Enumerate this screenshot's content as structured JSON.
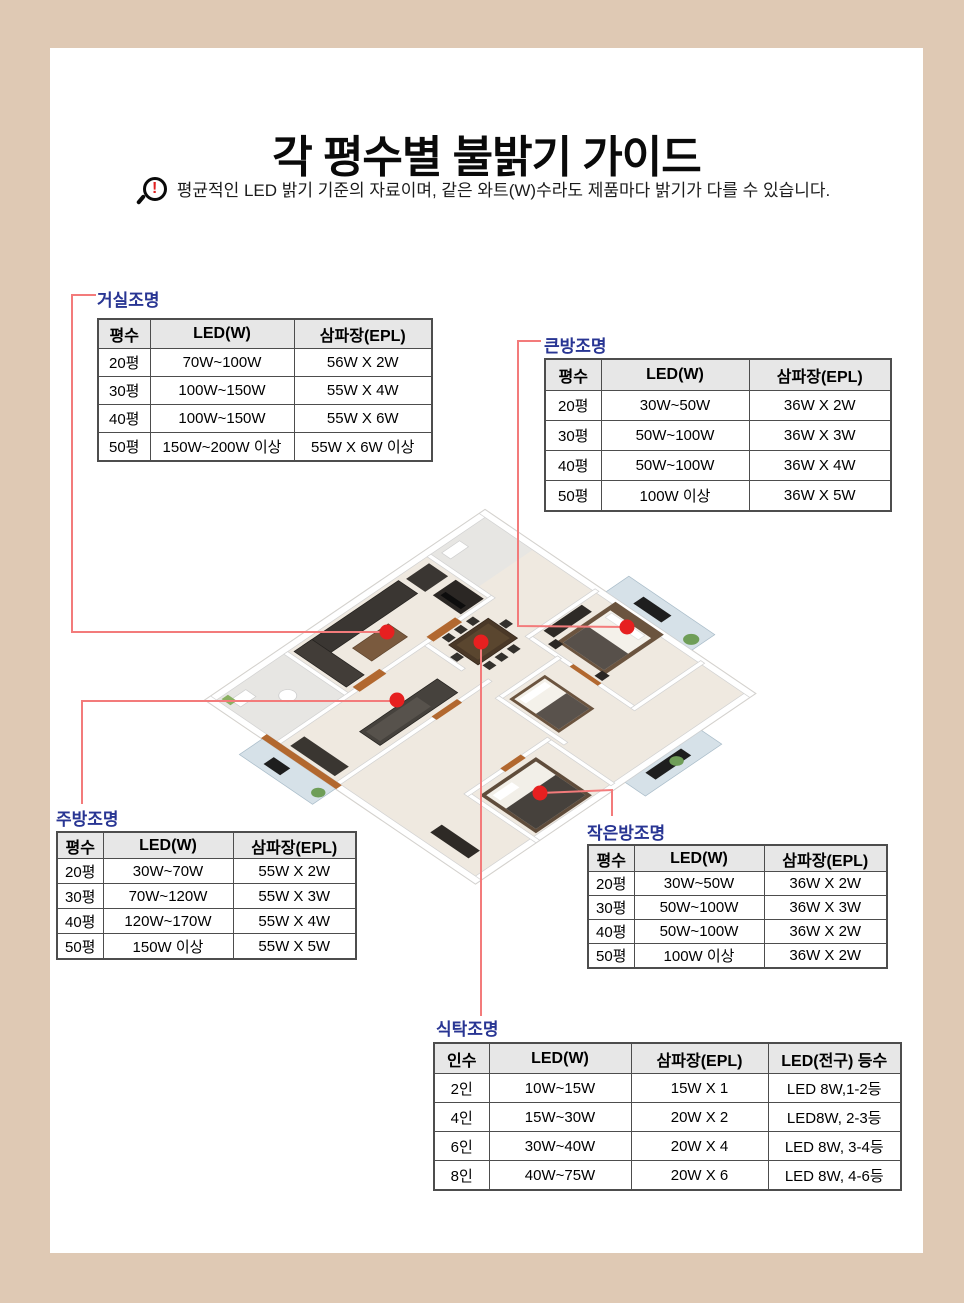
{
  "page": {
    "title": "각 평수별 불밝기 가이드",
    "disclaimer": "평균적인 LED 밝기 기준의 자료이며, 같은 와트(W)수라도 제품마다 밝기가 다를 수 있습니다.",
    "warn_icon_glyph": "!"
  },
  "colors": {
    "frame_background": "#dfc9b4",
    "section_label": "#283593",
    "connector_line": "#f37b7b",
    "marker_dot": "#e62020",
    "table_header_bg": "#e7e7e7",
    "table_border": "#4d4d4d"
  },
  "tables": {
    "living": {
      "label": "거실조명",
      "headers": [
        "평수",
        "LED(W)",
        "삼파장(EPL)"
      ],
      "rows": [
        [
          "20평",
          "70W~100W",
          "56W X 2W"
        ],
        [
          "30평",
          "100W~150W",
          "55W X 4W"
        ],
        [
          "40평",
          "100W~150W",
          "55W X 6W"
        ],
        [
          "50평",
          "150W~200W 이상",
          "55W X 6W 이상"
        ]
      ]
    },
    "big_room": {
      "label": "큰방조명",
      "headers": [
        "평수",
        "LED(W)",
        "삼파장(EPL)"
      ],
      "rows": [
        [
          "20평",
          "30W~50W",
          "36W X 2W"
        ],
        [
          "30평",
          "50W~100W",
          "36W X 3W"
        ],
        [
          "40평",
          "50W~100W",
          "36W X 4W"
        ],
        [
          "50평",
          "100W 이상",
          "36W X 5W"
        ]
      ]
    },
    "kitchen": {
      "label": "주방조명",
      "headers": [
        "평수",
        "LED(W)",
        "삼파장(EPL)"
      ],
      "rows": [
        [
          "20평",
          "30W~70W",
          "55W X 2W"
        ],
        [
          "30평",
          "70W~120W",
          "55W X 3W"
        ],
        [
          "40평",
          "120W~170W",
          "55W X 4W"
        ],
        [
          "50평",
          "150W 이상",
          "55W X 5W"
        ]
      ]
    },
    "small_room": {
      "label": "작은방조명",
      "headers": [
        "평수",
        "LED(W)",
        "삼파장(EPL)"
      ],
      "rows": [
        [
          "20평",
          "30W~50W",
          "36W X 2W"
        ],
        [
          "30평",
          "50W~100W",
          "36W X 3W"
        ],
        [
          "40평",
          "50W~100W",
          "36W X 2W"
        ],
        [
          "50평",
          "100W 이상",
          "36W X 2W"
        ]
      ]
    },
    "dining": {
      "label": "식탁조명",
      "headers": [
        "인수",
        "LED(W)",
        "삼파장(EPL)",
        "LED(전구) 등수"
      ],
      "rows": [
        [
          "2인",
          "10W~15W",
          "15W X 1",
          "LED 8W,1-2등"
        ],
        [
          "4인",
          "15W~30W",
          "20W X 2",
          "LED8W, 2-3등"
        ],
        [
          "6인",
          "30W~40W",
          "20W X 4",
          "LED 8W, 3-4등"
        ],
        [
          "8인",
          "40W~75W",
          "20W X 6",
          "LED 8W, 4-6등"
        ]
      ]
    }
  }
}
